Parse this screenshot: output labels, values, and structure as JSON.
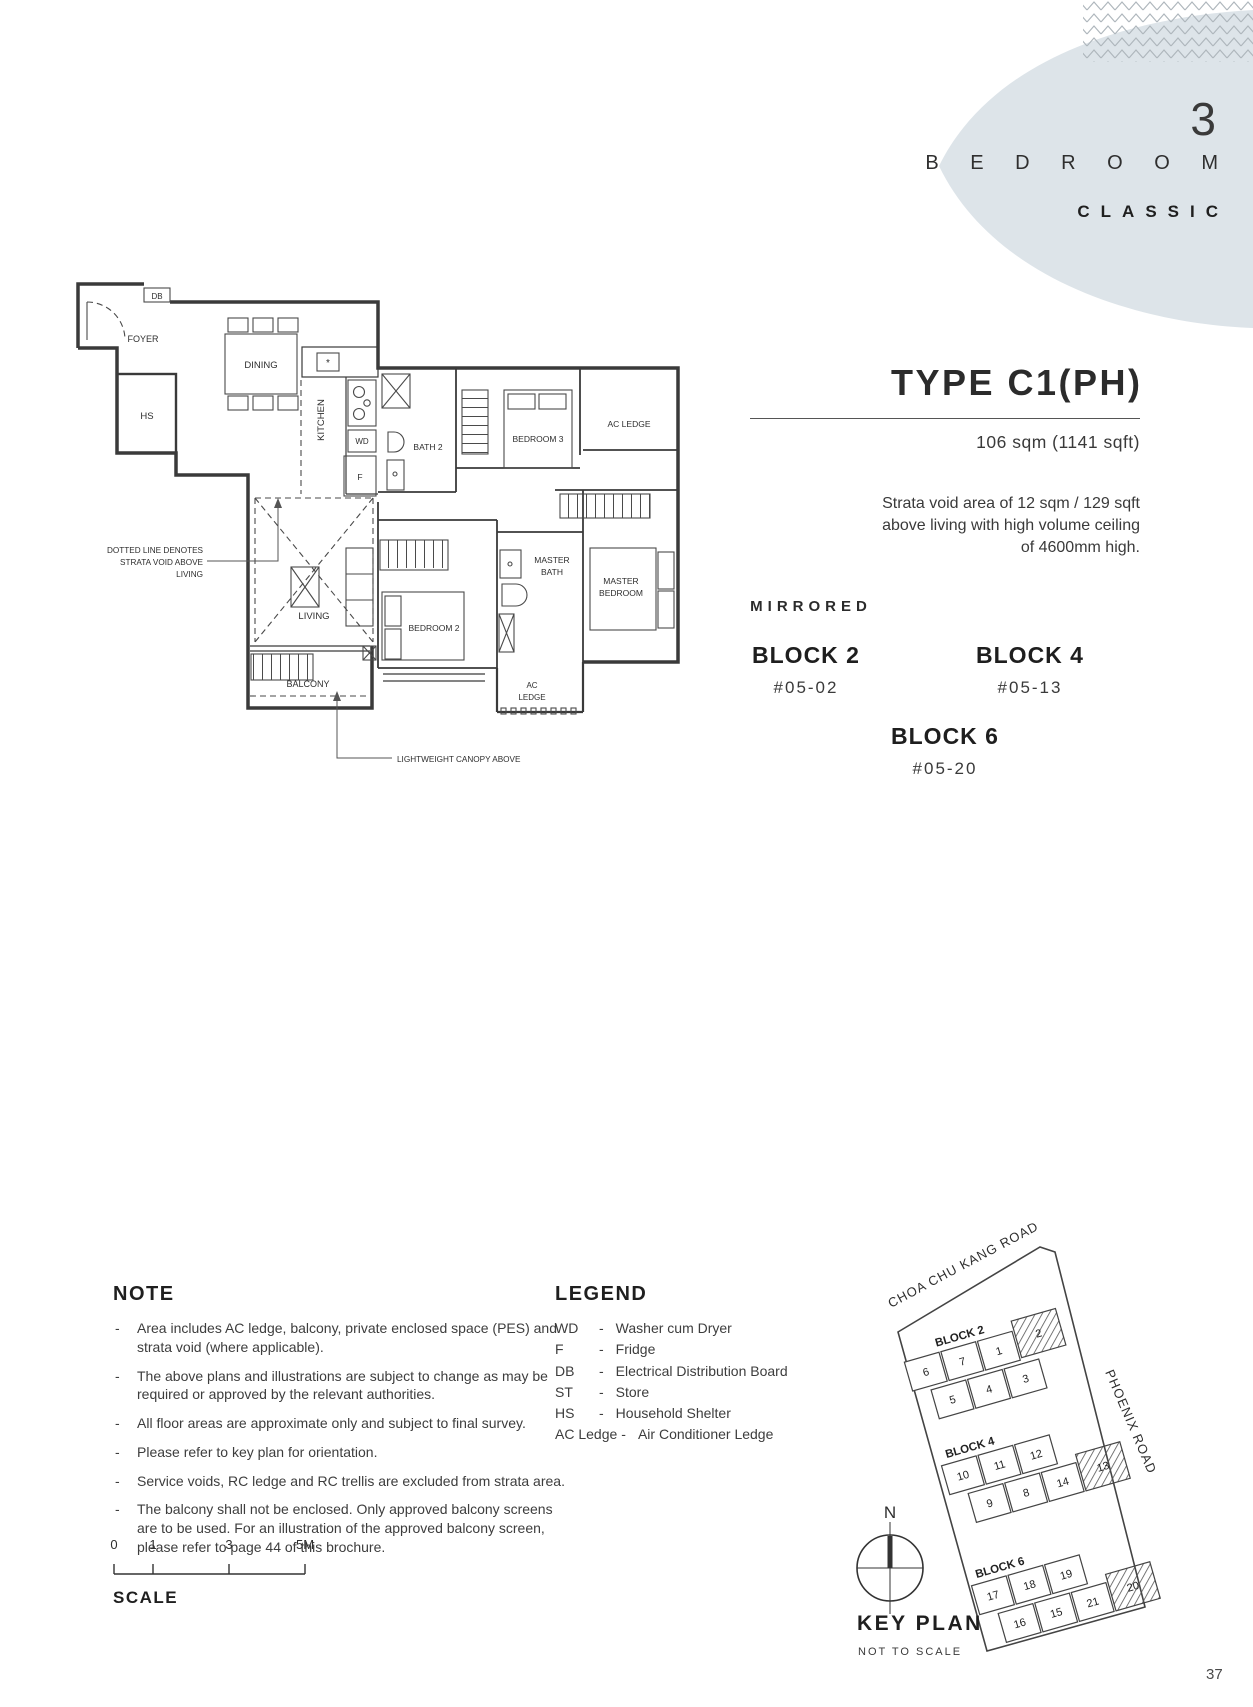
{
  "page": {
    "number": "37"
  },
  "header": {
    "count": "3",
    "bedroom": "B E D R O O M",
    "style": "CLASSIC"
  },
  "unit": {
    "type_title": "TYPE C1(PH)",
    "area": "106 sqm (1141 sqft)",
    "strata_lines": [
      "Strata void area of 12 sqm / 129 sqft",
      "above living with high volume ceiling",
      "of 4600mm high."
    ],
    "mirrored": "MIRRORED",
    "blocks": [
      {
        "name": "BLOCK 2",
        "unit_no": "#05-02"
      },
      {
        "name": "BLOCK 4",
        "unit_no": "#05-13"
      },
      {
        "name": "BLOCK 6",
        "unit_no": "#05-20"
      }
    ]
  },
  "floorplan": {
    "labels": {
      "db": "DB",
      "foyer": "FOYER",
      "hs": "HS",
      "dining": "DINING",
      "kitchen": "KITCHEN",
      "wd": "WD",
      "f": "F",
      "sink_mark": "*",
      "bath2": "BATH 2",
      "bedroom3": "BEDROOM 3",
      "ac_ledge_top": "AC LEDGE",
      "master_bath_l1": "MASTER",
      "master_bath_l2": "BATH",
      "master_bedroom_l1": "MASTER",
      "master_bedroom_l2": "BEDROOM",
      "living": "LIVING",
      "bedroom2": "BEDROOM 2",
      "balcony": "BALCONY",
      "ac_l1": "AC",
      "ac_l2": "LEDGE"
    },
    "annotations": {
      "void_l1": "DOTTED LINE DENOTES",
      "void_l2": "STRATA VOID ABOVE",
      "void_l3": "LIVING",
      "canopy": "LIGHTWEIGHT CANOPY ABOVE"
    }
  },
  "note": {
    "heading": "NOTE",
    "bullet": "-",
    "items": [
      "Area includes AC ledge, balcony, private enclosed space (PES) and strata void (where applicable).",
      "The above plans and illustrations are subject to change as may be required or approved by the relevant authorities.",
      "All floor areas are approximate only and subject to final survey.",
      "Please refer to key plan for orientation.",
      "Service voids, RC ledge and RC trellis are excluded from strata area.",
      "The balcony shall not be enclosed. Only approved balcony screens are to be used. For an illustration of the approved balcony screen, please refer to page 44 of this brochure."
    ]
  },
  "legend": {
    "heading": "LEGEND",
    "separator": "-",
    "items": [
      {
        "abbr": "WD",
        "desc": "Washer cum Dryer"
      },
      {
        "abbr": "F",
        "desc": "Fridge"
      },
      {
        "abbr": "DB",
        "desc": "Electrical Distribution Board"
      },
      {
        "abbr": "ST",
        "desc": "Store"
      },
      {
        "abbr": "HS",
        "desc": "Household Shelter"
      },
      {
        "abbr": "AC Ledge",
        "desc": "Air Conditioner Ledge"
      }
    ]
  },
  "keyplan": {
    "heading": "KEY PLAN",
    "subheading": "NOT TO SCALE",
    "north": "N",
    "road_top": "CHOA CHU KANG ROAD",
    "road_right": "PHOENIX ROAD",
    "blocks": [
      {
        "label": "BLOCK 2",
        "row1": [
          "6",
          "7",
          "1"
        ],
        "row2": [
          "5",
          "4",
          "3"
        ],
        "highlighted": "2"
      },
      {
        "label": "BLOCK 4",
        "row1": [
          "10",
          "11",
          "12"
        ],
        "row2": [
          "9",
          "8",
          "14"
        ],
        "highlighted": "13"
      },
      {
        "label": "BLOCK 6",
        "row1": [
          "17",
          "18",
          "19"
        ],
        "row2": [
          "16",
          "15",
          "21"
        ],
        "highlighted": "20"
      }
    ]
  },
  "scalebar": {
    "ticks": [
      "0",
      "1",
      "3",
      "5M"
    ],
    "label": "SCALE"
  },
  "colors": {
    "accent_blob": "#dde4e9",
    "zigzag": "#aeb6bc",
    "ink": "#2e2e2e"
  }
}
